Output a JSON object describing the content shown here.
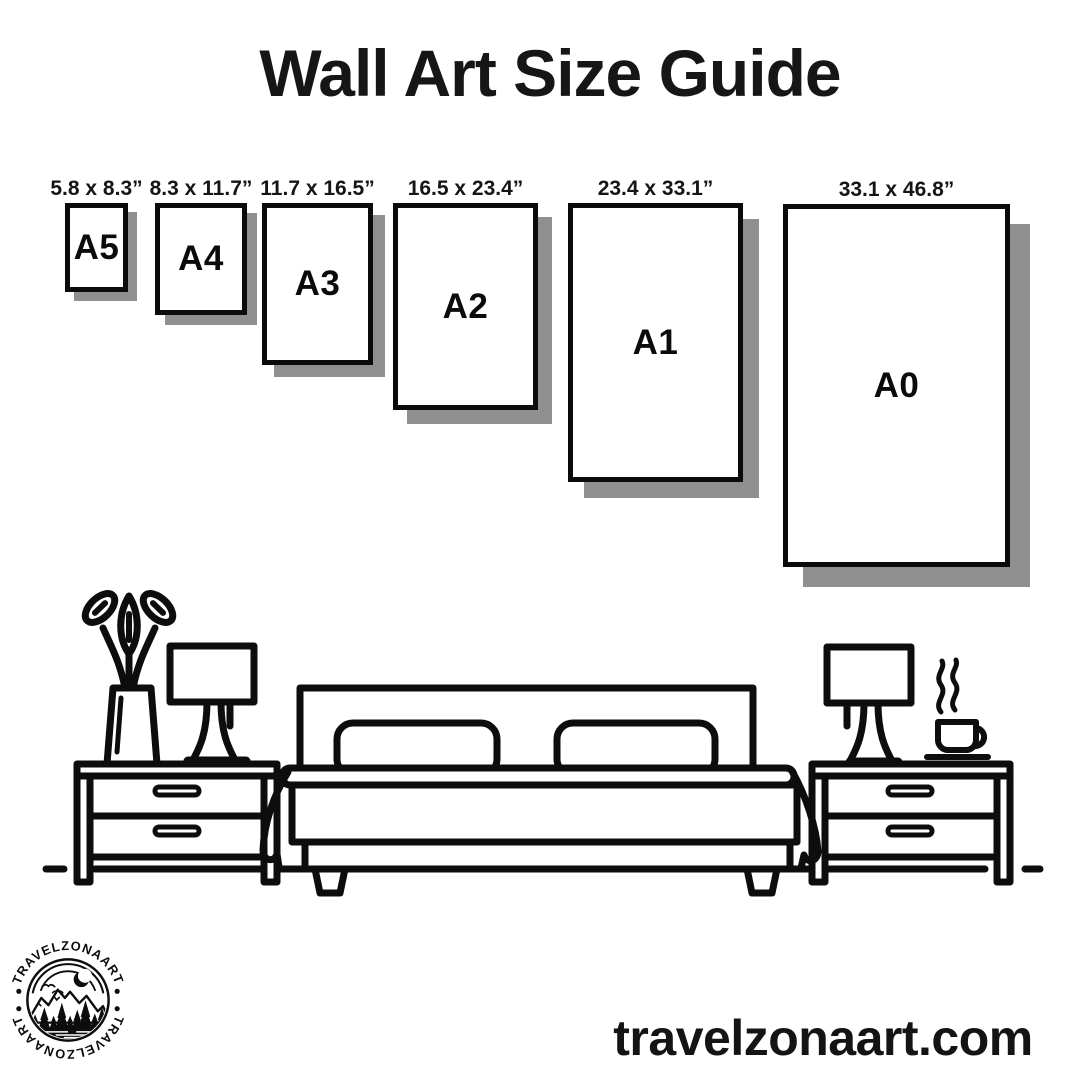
{
  "page": {
    "title": "Wall Art Size Guide"
  },
  "sizes": [
    {
      "code": "A5",
      "dims": "5.8 x 8.3”"
    },
    {
      "code": "A4",
      "dims": "8.3 x 11.7”"
    },
    {
      "code": "A3",
      "dims": "11.7 x 16.5”"
    },
    {
      "code": "A2",
      "dims": "16.5 x 23.4”"
    },
    {
      "code": "A1",
      "dims": "23.4 x 33.1”"
    },
    {
      "code": "A0",
      "dims": "33.1 x 46.8”"
    }
  ],
  "branding": {
    "logo_text": "TRAVELZONAART",
    "website": "travelzonaart.com"
  },
  "illustration": {
    "items": [
      "potted-plant",
      "table-lamp",
      "nightstand",
      "double-bed",
      "pillows",
      "nightstand",
      "table-lamp",
      "coffee-cup"
    ]
  },
  "colors": {
    "background": "#ffffff",
    "ink": "#0d0d0d",
    "shadow": "#8f8f8f"
  }
}
